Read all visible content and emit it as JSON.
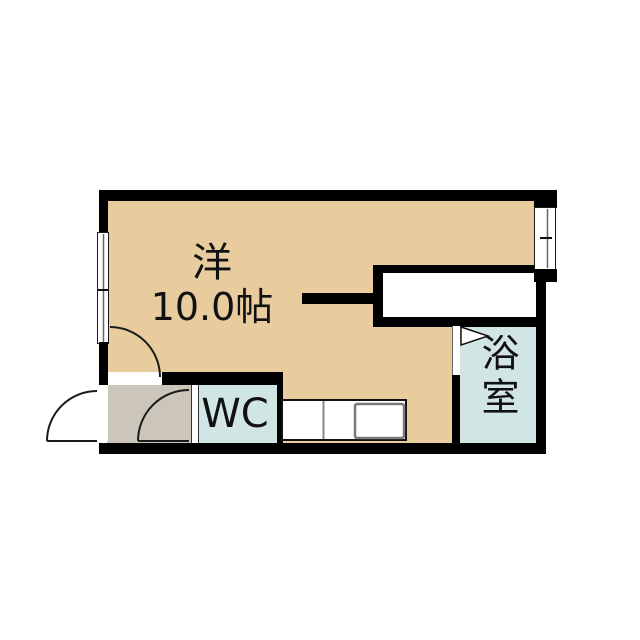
{
  "floorplan": {
    "main_room": {
      "type_label": "洋",
      "area_label": "10.0帖"
    },
    "toilet": {
      "label": "WC"
    },
    "bathroom": {
      "label": "浴室"
    },
    "colors": {
      "room_tan": "#e8cc9e",
      "wet_area_cyan": "#d2e5e5",
      "entry_gray": "#cbc6b9",
      "wall_black": "#000000"
    }
  }
}
